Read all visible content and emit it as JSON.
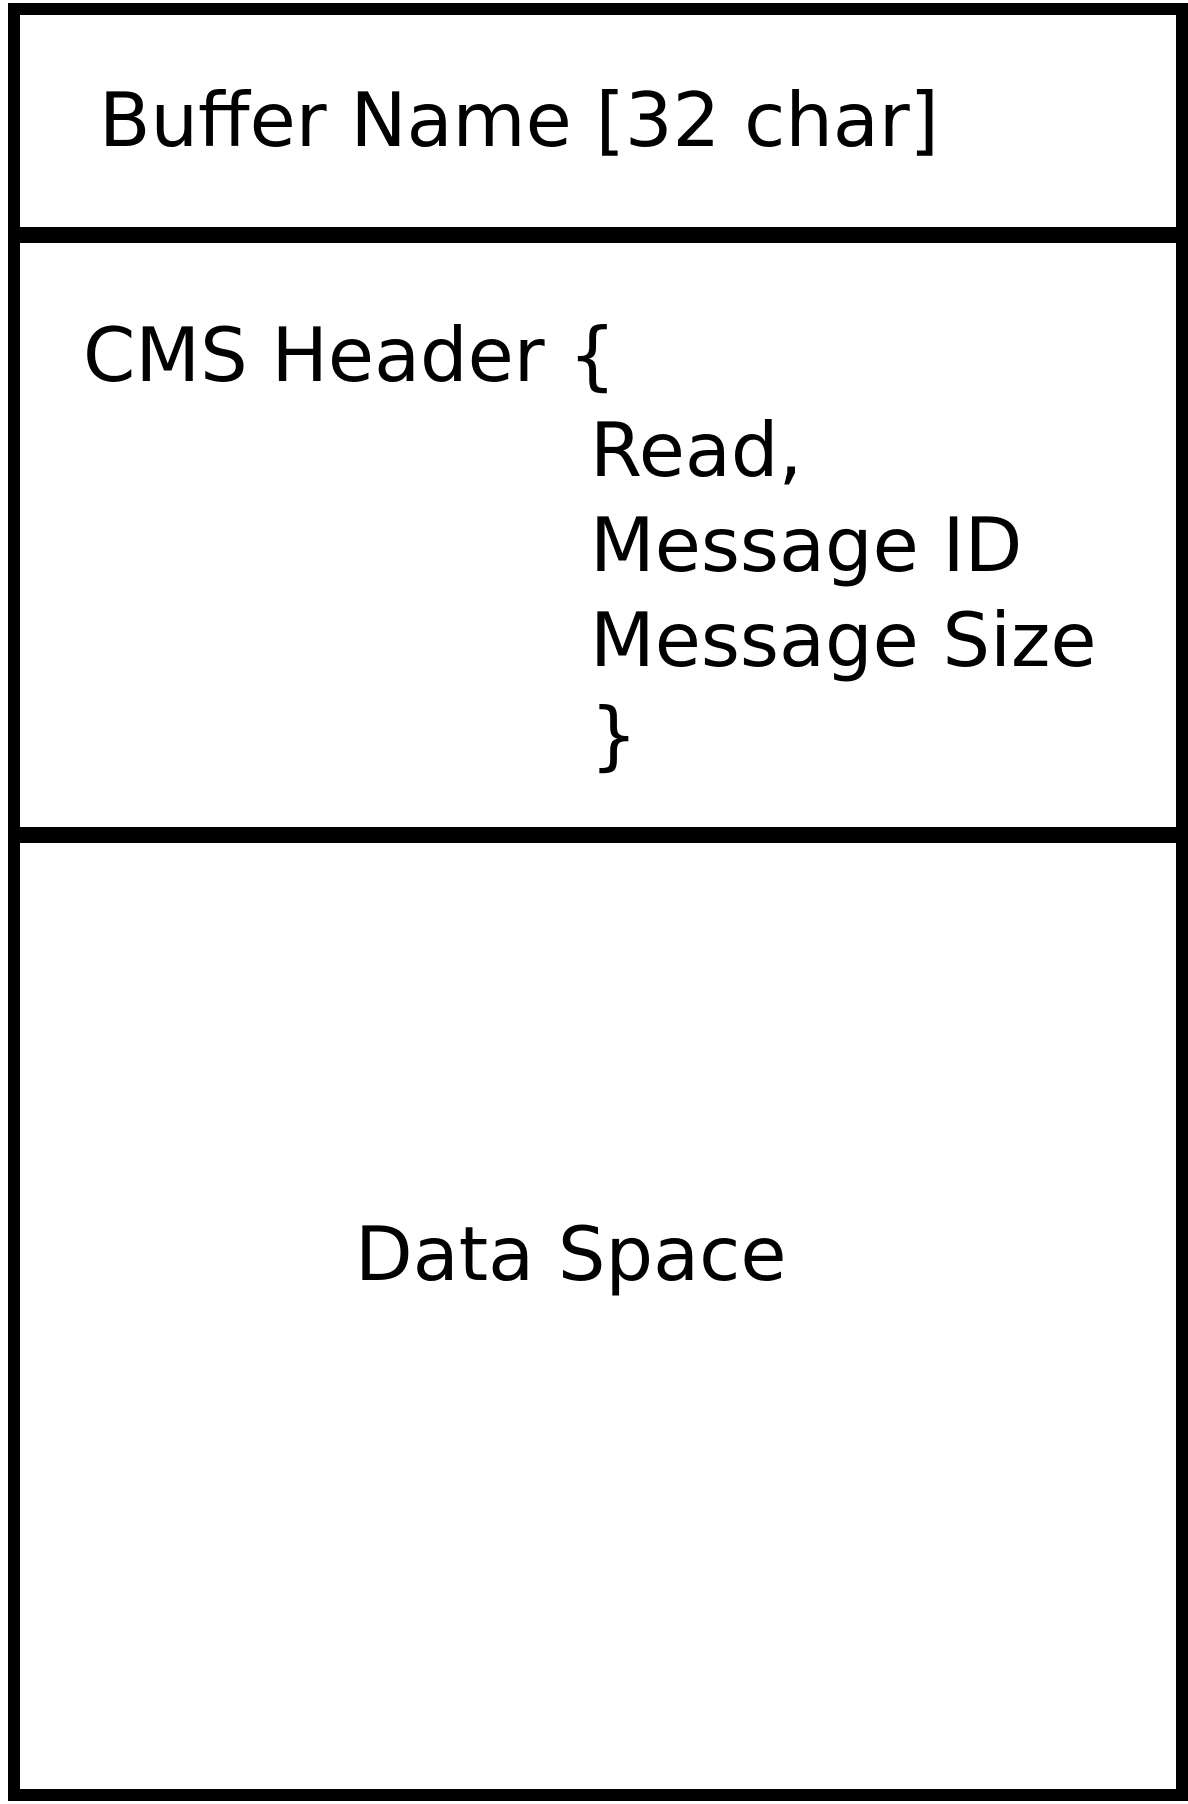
{
  "diagram": {
    "background": "#ffffff",
    "line_color": "#000000",
    "text_color": "#000000",
    "sections": {
      "buffer_name": {
        "label": "Buffer Name [32 char]"
      },
      "cms_header": {
        "open": "CMS Header {",
        "fields": [
          "Read,",
          "Message ID",
          "Message Size"
        ],
        "close": "}"
      },
      "data_space": {
        "label": "Data Space"
      }
    }
  }
}
